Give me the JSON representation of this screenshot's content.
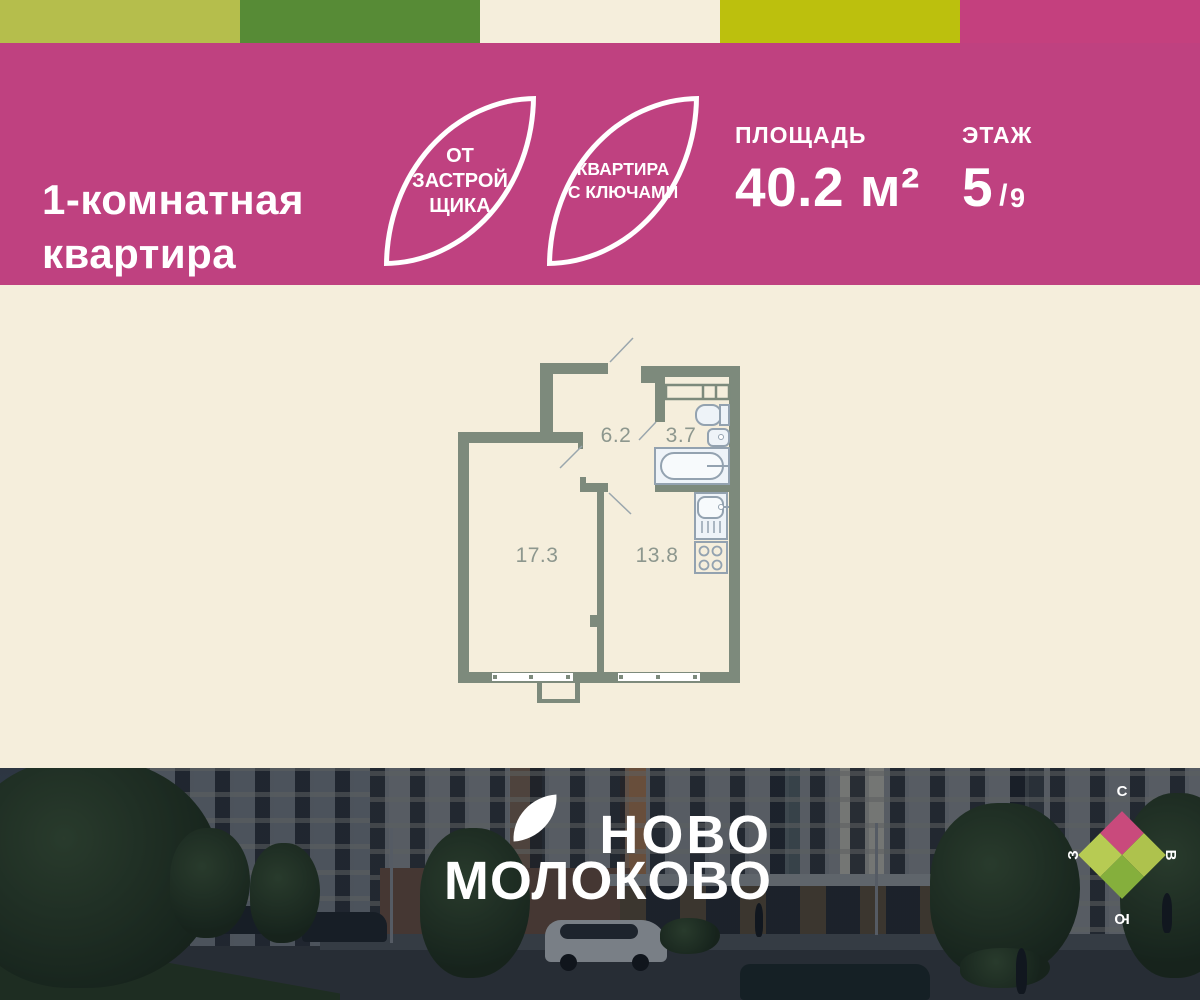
{
  "palette": {
    "strip": [
      "#b5be4c",
      "#578b36",
      "#f5eedc",
      "#bcc00d",
      "#c4407e"
    ],
    "header_bg": "#bf4180",
    "plan_bg": "#f5eedc",
    "wall": "#7d8a7c",
    "fixture": "#93a2b0",
    "room_label": "#8d978e"
  },
  "header": {
    "title_line1": "1-комнатная",
    "title_line2": "квартира",
    "badge_developer": {
      "line1": "ОТ",
      "line2": "ЗАСТРОЙ",
      "line3": "ЩИКА"
    },
    "badge_keys": {
      "line1": "КВАРТИРА",
      "line2": "С КЛЮЧАМИ"
    },
    "area": {
      "label": "ПЛОЩАДЬ",
      "value": "40.2 м²"
    },
    "floor": {
      "label": "ЭТАЖ",
      "value": "5",
      "separator": "/",
      "total": "9"
    }
  },
  "floorplan": {
    "rooms": {
      "hallway": "6.2",
      "bathroom": "3.7",
      "living": "17.3",
      "kitchen": "13.8"
    }
  },
  "footer": {
    "brand_line1": "НОВО",
    "brand_line2": "МОЛОКОВО",
    "compass": {
      "north": {
        "label": "С",
        "color": "#c94a7c"
      },
      "east": {
        "label": "В",
        "color": "#aec24d"
      },
      "south": {
        "label": "Ю",
        "color": "#85af3c"
      },
      "west": {
        "label": "З",
        "color": "#b7cb53"
      }
    }
  }
}
